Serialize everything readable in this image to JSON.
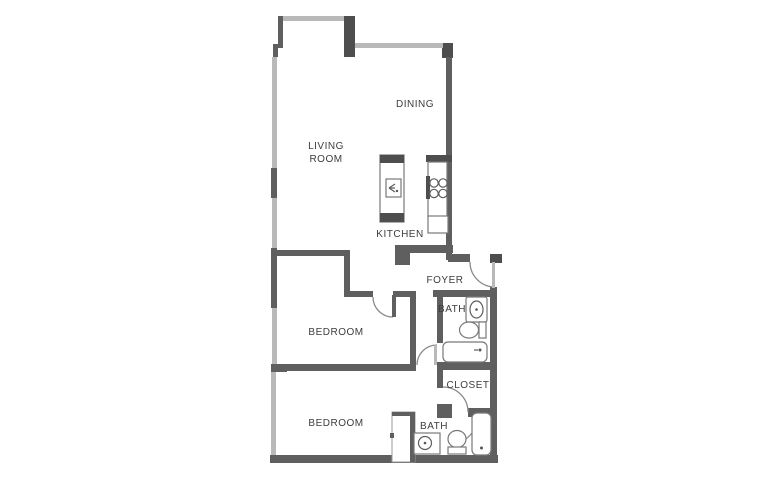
{
  "floor_plan": {
    "labels": {
      "living_room_line1": "LIVING",
      "living_room_line2": "ROOM",
      "dining": "DINING",
      "kitchen": "KITCHEN",
      "foyer": "FOYER",
      "bath_upper": "BATH",
      "closet": "CLOSET",
      "bath_lower": "BATH",
      "bedroom_upper": "BEDROOM",
      "bedroom_lower": "BEDROOM"
    },
    "colors": {
      "wall": "#5f5f5f",
      "wall_dark": "#4e4e4e",
      "window": "#b9b9b9",
      "fixture_outline": "#787878",
      "door_arc": "#8a8a8a",
      "label_text": "#3d3d3d",
      "background": "#ffffff"
    }
  }
}
